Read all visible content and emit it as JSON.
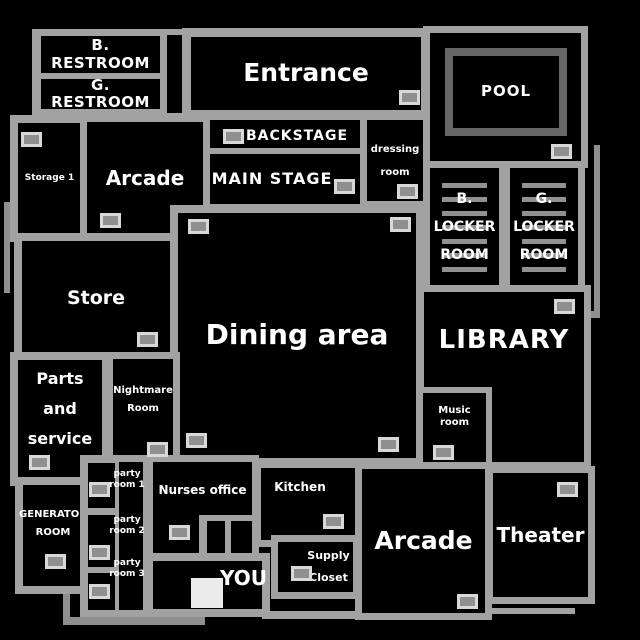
{
  "map": {
    "background_color": "#000000",
    "wall_color": "#a2a2a2",
    "outer_wall_color": "#8f8f8f",
    "door_fill_color": "#8f8f8f",
    "door_border_color": "#d8d8d8",
    "pool_border_color": "#666666",
    "locker_stripe_color": "#919191",
    "text_color": "#ffffff",
    "player_square_color": "#ebebeb"
  },
  "rooms": {
    "b_restroom": {
      "label": "B. RESTROOM"
    },
    "g_restroom": {
      "label": "G. RESTROOM"
    },
    "entrance": {
      "label": "Entrance"
    },
    "pool": {
      "label": "POOL"
    },
    "backstage": {
      "label": "BACKSTAGE"
    },
    "main_stage": {
      "label": "MAIN STAGE"
    },
    "dressing_room": {
      "line1": "dressing",
      "line2": "room"
    },
    "storage1": {
      "label": "Storage 1"
    },
    "arcade_top": {
      "label": "Arcade"
    },
    "b_locker": {
      "line1": "B.",
      "line2": "LOCKER",
      "line3": "ROOM"
    },
    "g_locker": {
      "line1": "G.",
      "line2": "LOCKER",
      "line3": "ROOM"
    },
    "store": {
      "label": "Store"
    },
    "dining": {
      "label": "Dining area"
    },
    "library": {
      "label": "LIBRARY"
    },
    "music": {
      "label": "Music room"
    },
    "parts_service": {
      "line1": "Parts and",
      "line2": "service"
    },
    "nightmare": {
      "line1": "Nightmare",
      "line2": "Room"
    },
    "generator": {
      "line1": "GENERATOR",
      "line2": "ROOM"
    },
    "party1": {
      "line1": "party",
      "line2": "room 1"
    },
    "party2": {
      "line1": "party",
      "line2": "room 2"
    },
    "party3": {
      "line1": "party",
      "line2": "room 3"
    },
    "nurses": {
      "label": "Nurses office"
    },
    "kitchen": {
      "label": "Kitchen"
    },
    "supply": {
      "line1": "Supply",
      "line2": "Closet"
    },
    "you": {
      "label": "YOU"
    },
    "arcade_bottom": {
      "label": "Arcade"
    },
    "theater": {
      "label": "Theater"
    }
  }
}
